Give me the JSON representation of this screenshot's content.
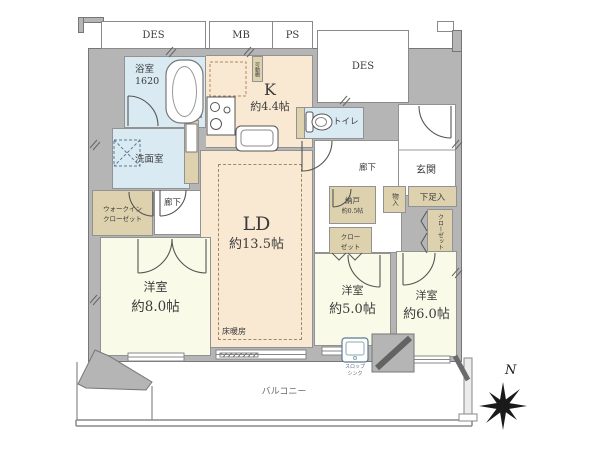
{
  "plan": {
    "top": {
      "des_left": "DES",
      "mb": "MB",
      "ps": "PS",
      "des_right": "DES"
    },
    "rooms": {
      "bath": {
        "name": "浴室\n1620"
      },
      "kitchen": {
        "name": "K",
        "size": "約4.4帖"
      },
      "shelf": {
        "name": "可動棚"
      },
      "toilet": {
        "name": "トイレ"
      },
      "washroom": {
        "name": "洗面室"
      },
      "linen": {
        "name": "リネン庫"
      },
      "hall_left": {
        "name": "廊下"
      },
      "hall_right": {
        "name": "廊下"
      },
      "wic": {
        "name": "ウォークイン\nクローゼット"
      },
      "ld": {
        "name": "LD",
        "size": "約13.5帖"
      },
      "floor_heating": {
        "name": "床暖房"
      },
      "nando": {
        "name": "納戸",
        "size": "約0.5帖"
      },
      "closet_center": {
        "name": "クロー\nゼット"
      },
      "genkan": {
        "name": "玄関"
      },
      "monoire": {
        "name": "物入"
      },
      "shoebox": {
        "name": "下足入"
      },
      "closet_right": {
        "name": "クローゼット"
      },
      "bedroom8": {
        "name": "洋室",
        "size": "約8.0帖"
      },
      "bedroom5": {
        "name": "洋室",
        "size": "約5.0帖"
      },
      "bedroom6": {
        "name": "洋室",
        "size": "約6.0帖"
      },
      "balcony": {
        "name": "バルコニー"
      },
      "slop_sink": {
        "name": "スロップ\nシンク"
      }
    },
    "compass": {
      "north": "N"
    },
    "colors": {
      "wall": "#b5b5b5",
      "water": "#d9eaf3",
      "warm": "#f9e9d3",
      "bedroom": "#fafae8",
      "closet": "#ddd2ad",
      "line": "#555555"
    }
  }
}
